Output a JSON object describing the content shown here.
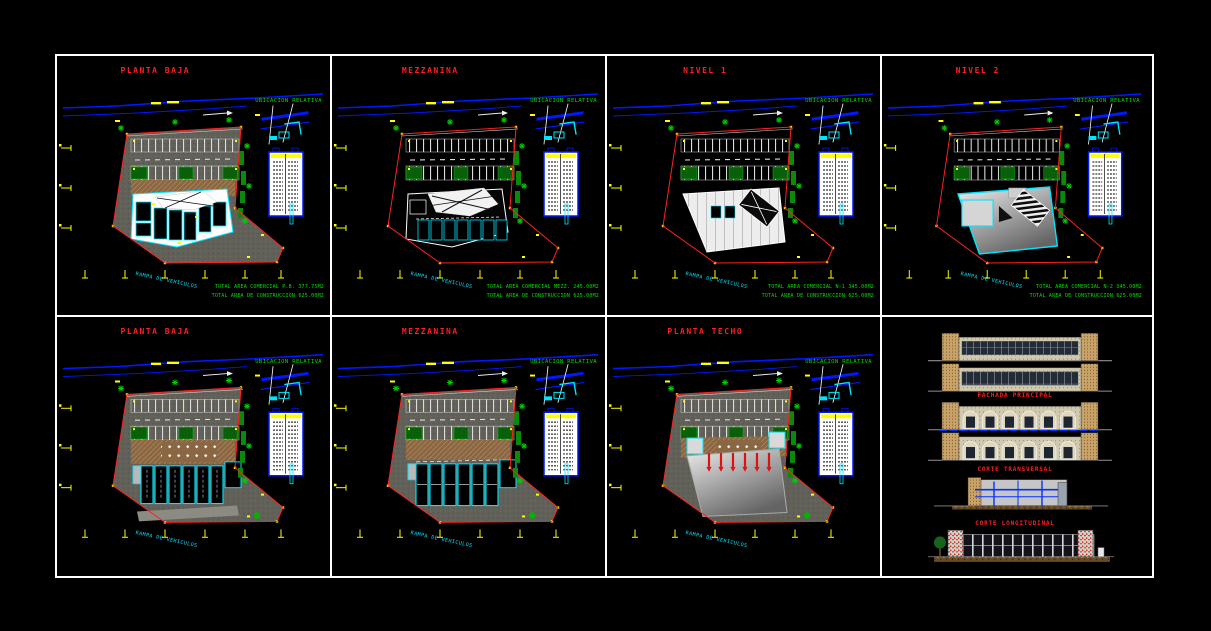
{
  "colors": {
    "background": "#000000",
    "frame_white": "#ffffff",
    "title_red": "#ff1e1e",
    "annotation_green": "#00e000",
    "dimension_yellow": "#ffff00",
    "wall_cyan": "#00e5ff",
    "road_blue": "#0018ff",
    "boundary_red": "#ff2020",
    "site_gray": "#61615a",
    "plaza_brown": "#8a6742"
  },
  "sheet": {
    "panels": [
      {
        "id": "planta-baja-1",
        "title": "PLANTA BAJA",
        "location_label": "UBICACION RELATIVA",
        "ramp_label": "RAMPA DE VEHICULOS",
        "totals": {
          "line1": "TOTAL AREA COMERCIAL P.B. 377.75M2",
          "line2": "TOTAL AREA DE CONSTRUCCION 625.00M2"
        }
      },
      {
        "id": "mezzanina-1",
        "title": "MEZZANINA",
        "location_label": "UBICACION RELATIVA",
        "ramp_label": "RAMPA DE VEHICULOS",
        "totals": {
          "line1": "TOTAL AREA COMERCIAL MEZZ. 245.00M2",
          "line2": "TOTAL AREA DE CONSTRUCCION 625.00M2"
        }
      },
      {
        "id": "nivel-1",
        "title": "NIVEL 1",
        "location_label": "UBICACION RELATIVA",
        "ramp_label": "RAMPA DE VEHICULOS",
        "totals": {
          "line1": "TOTAL AREA COMERCIAL N-1 345.00M2",
          "line2": "TOTAL AREA DE CONSTRUCCION 625.00M2"
        }
      },
      {
        "id": "nivel-2",
        "title": "NIVEL 2",
        "location_label": "UBICACION RELATIVA",
        "ramp_label": "RAMPA DE VEHICULOS",
        "totals": {
          "line1": "TOTAL AREA COMERCIAL N-2 345.00M2",
          "line2": "TOTAL AREA DE CONSTRUCCION 625.00M2"
        }
      },
      {
        "id": "planta-baja-2",
        "title": "PLANTA BAJA",
        "location_label": "UBICACION RELATIVA",
        "ramp_label": "RAMPA DE VEHICULOS",
        "totals": {
          "line1": "",
          "line2": ""
        }
      },
      {
        "id": "mezzanina-2",
        "title": "MEZZANINA",
        "location_label": "UBICACION RELATIVA",
        "ramp_label": "RAMPA DE VEHICULOS",
        "totals": {
          "line1": "",
          "line2": ""
        }
      },
      {
        "id": "planta-techo",
        "title": "PLANTA TECHO",
        "location_label": "UBICACION RELATIVA",
        "ramp_label": "RAMPA DE VEHICULOS",
        "totals": {
          "line1": "",
          "line2": ""
        }
      }
    ],
    "elevations": {
      "fachada_label": "FACHADA PRINCIPAL",
      "corte_transversal_label": "CORTE TRANSVERSAL",
      "corte_longitudinal_label": "CORTE LONGITUDINAL"
    }
  }
}
